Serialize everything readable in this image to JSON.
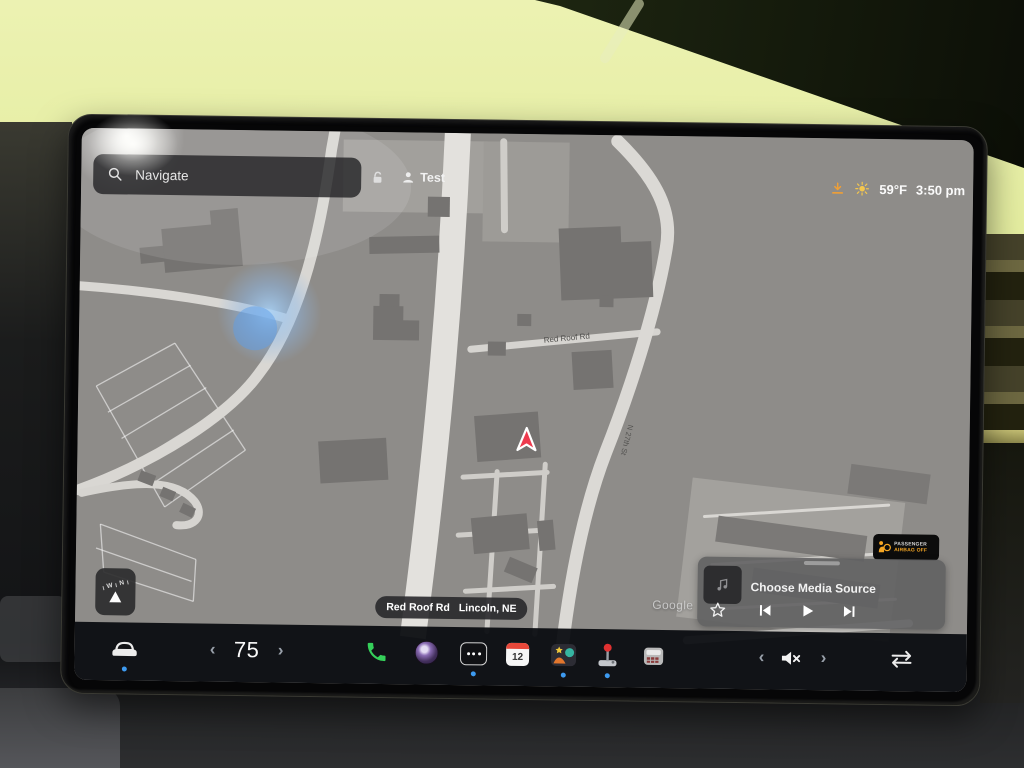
{
  "status_bar": {
    "search_label": "Navigate",
    "profile_name": "Test",
    "outside_temp": "59°F",
    "clock": "3:50 pm"
  },
  "map": {
    "road_label": "Red Roof Rd",
    "road_label_vertical": "N 27th St",
    "current_street": "Red Roof Rd",
    "current_city": "Lincoln, NE",
    "attribution": "Google",
    "compass_north": "N",
    "compass_west": "W"
  },
  "passenger_airbag": {
    "line1": "PASSENGER",
    "line2": "AIRBAG OFF"
  },
  "media_player": {
    "source_prompt": "Choose Media Source"
  },
  "launcher": {
    "climate_temp": "75",
    "calendar_day": "12"
  },
  "ui": {
    "chevron_left": "‹",
    "chevron_right": "›"
  },
  "colors": {
    "accent_blue_dot": "#3d9af0",
    "phone_green": "#35d05a",
    "nav_arrow_red": "#ee3a4e",
    "warning_orange": "#f5a623",
    "sun_yellow": "#f3c64e",
    "download_orange": "#ef9f36"
  }
}
